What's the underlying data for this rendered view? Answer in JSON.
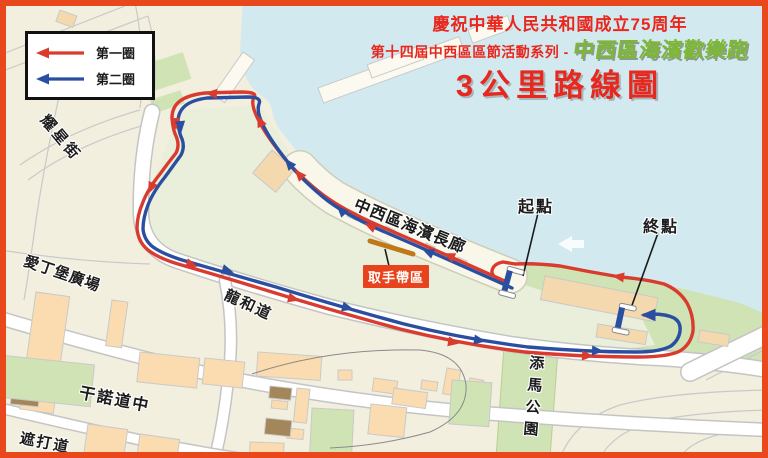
{
  "poster": {
    "legend": {
      "lap1_label": "第一圈",
      "lap2_label": "第二圈"
    },
    "title": {
      "line1": "慶祝中華人民共和國成立75周年",
      "line2_prefix": "第十四屆中西區區節活動系列 - ",
      "line2_highlight": "中西區海濱歡樂跑",
      "line3": "3公里路線圖"
    },
    "map_labels": {
      "yiu_sing_street": "耀星街",
      "edinburgh_place": "愛丁堡廣場",
      "lung_wo_road": "龍和道",
      "connaught_road_central": "干諾道中",
      "chater_road": "遮打道",
      "promenade": "中西區海濱長廊",
      "tamar_park": "添馬公園",
      "wristband_zone": "取手帶區",
      "start_point": "起點",
      "finish_point": "終點"
    },
    "colors": {
      "frame": "#e8481c",
      "route_lap1": "#d93b2f",
      "route_lap2": "#2b4fa0",
      "water": "#d2e9ef",
      "title_red": "#e8281e",
      "title_green": "#7db832",
      "marker_box": "#e8431c"
    }
  }
}
